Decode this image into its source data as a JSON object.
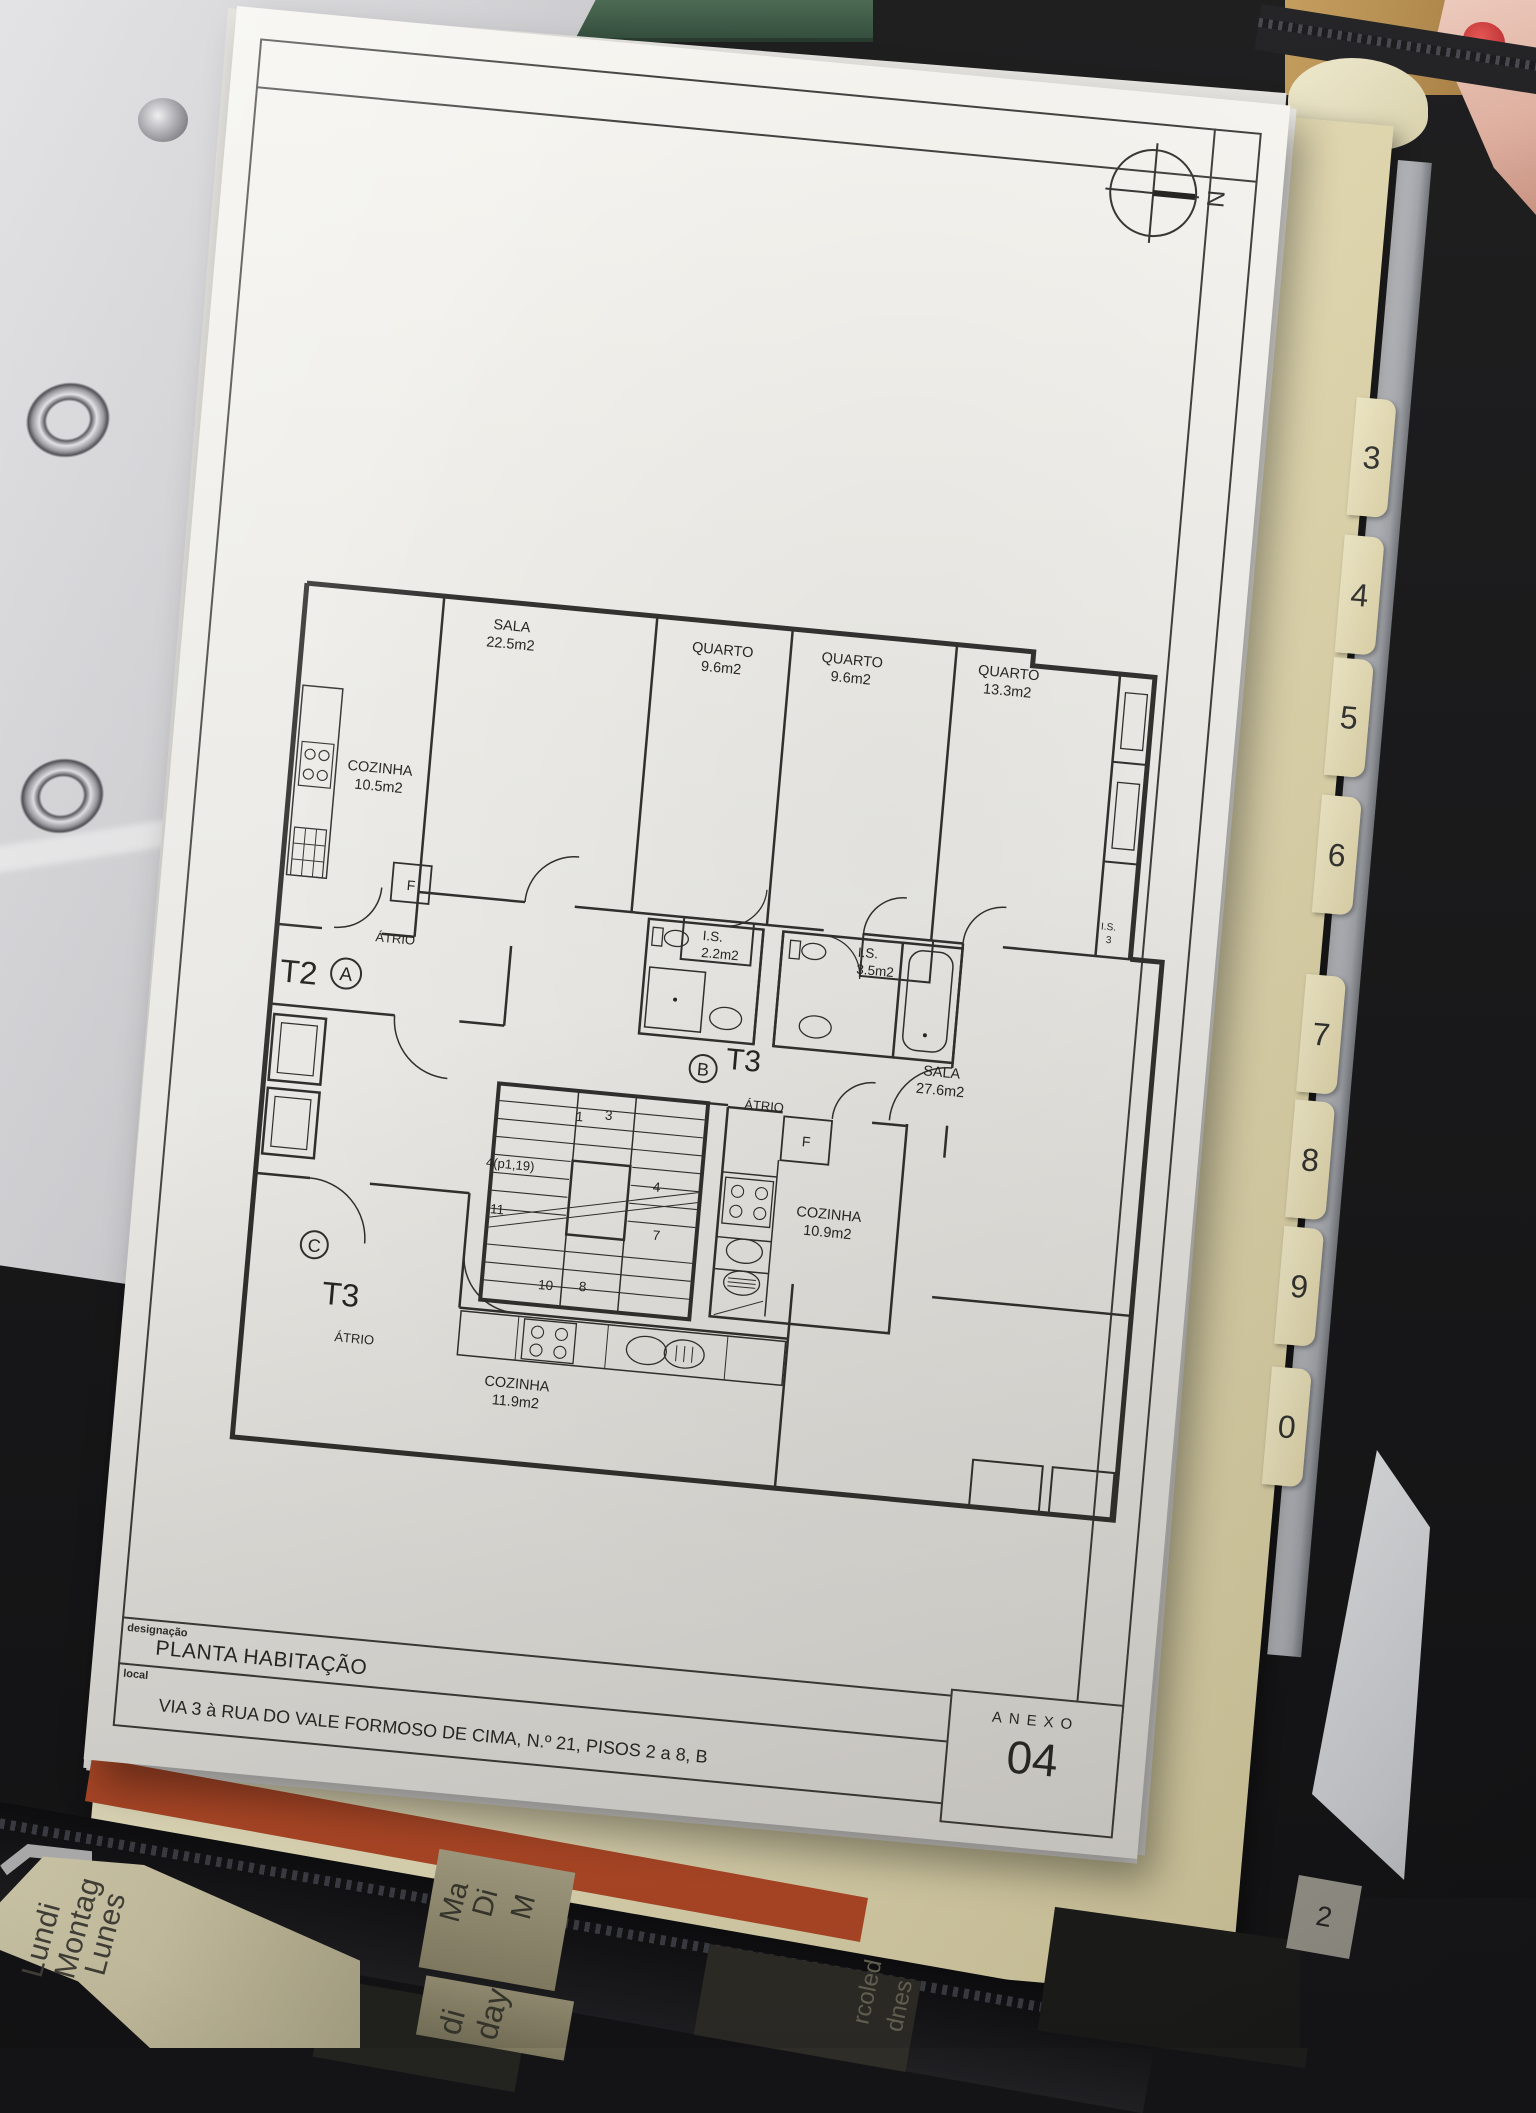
{
  "binder": {
    "tabs": [
      "3",
      "4",
      "5",
      "6",
      "7",
      "8",
      "9",
      "0"
    ],
    "partial_tab": "2"
  },
  "planners": {
    "left_days": [
      "Lundi",
      "Montag",
      "Lunes"
    ],
    "center_days_top": [
      "Ma",
      "Di",
      "M"
    ],
    "center_days_bottom": [
      "di",
      "day"
    ],
    "right_days": [
      "rcoled",
      "dnes"
    ]
  },
  "sheet": {
    "compass": "N",
    "title_block": {
      "designacao_label": "designação",
      "designacao": "PLANTA HABITAÇÃO",
      "local_label": "local",
      "local": "VIA 3 à RUA DO VALE FORMOSO DE CIMA, N.º 21, PISOS 2 a 8, B",
      "anexo_label": "ANEXO",
      "anexo_number": "04"
    },
    "plan": {
      "units": {
        "a": {
          "type": "T2",
          "letter": "A",
          "hall": "ÁTRIO"
        },
        "b": {
          "type": "T3",
          "letter": "B",
          "hall": "ÁTRIO"
        },
        "c": {
          "type": "T3",
          "letter": "C",
          "hall": "ÁTRIO"
        }
      },
      "rooms": {
        "sala1": {
          "name": "SALA",
          "area": "22.5m2"
        },
        "quarto1": {
          "name": "QUARTO",
          "area": "9.6m2"
        },
        "quarto2": {
          "name": "QUARTO",
          "area": "9.6m2"
        },
        "quarto3": {
          "name": "QUARTO",
          "area": "13.3m2"
        },
        "cozinha1": {
          "name": "COZINHA",
          "area": "10.5m2"
        },
        "is1": {
          "name": "I.S.",
          "area": "2.2m2"
        },
        "is2": {
          "name": "I.S.",
          "area": "3.5m2"
        },
        "is3": {
          "name": "I.S.",
          "area": "3"
        },
        "sala2": {
          "name": "SALA",
          "area": "27.6m2"
        },
        "cozinha2": {
          "name": "COZINHA",
          "area": "10.9m2"
        },
        "cozinha3": {
          "name": "COZINHA",
          "area": "11.9m2"
        }
      },
      "stairs": {
        "n1": "1",
        "n3": "3",
        "n4p": "4(p1,19)",
        "n4": "4",
        "n11": "11",
        "n7": "7",
        "n10": "10",
        "n8": "8"
      },
      "fridge_marker": "F"
    }
  },
  "colors": {
    "paper": "#f6f5f1",
    "ink": "#2e2d2b",
    "cream_tab": "#e8e0bb",
    "orange_sheet": "#c4532f",
    "binder_black": "#141416",
    "nail_red": "#b01f24"
  }
}
